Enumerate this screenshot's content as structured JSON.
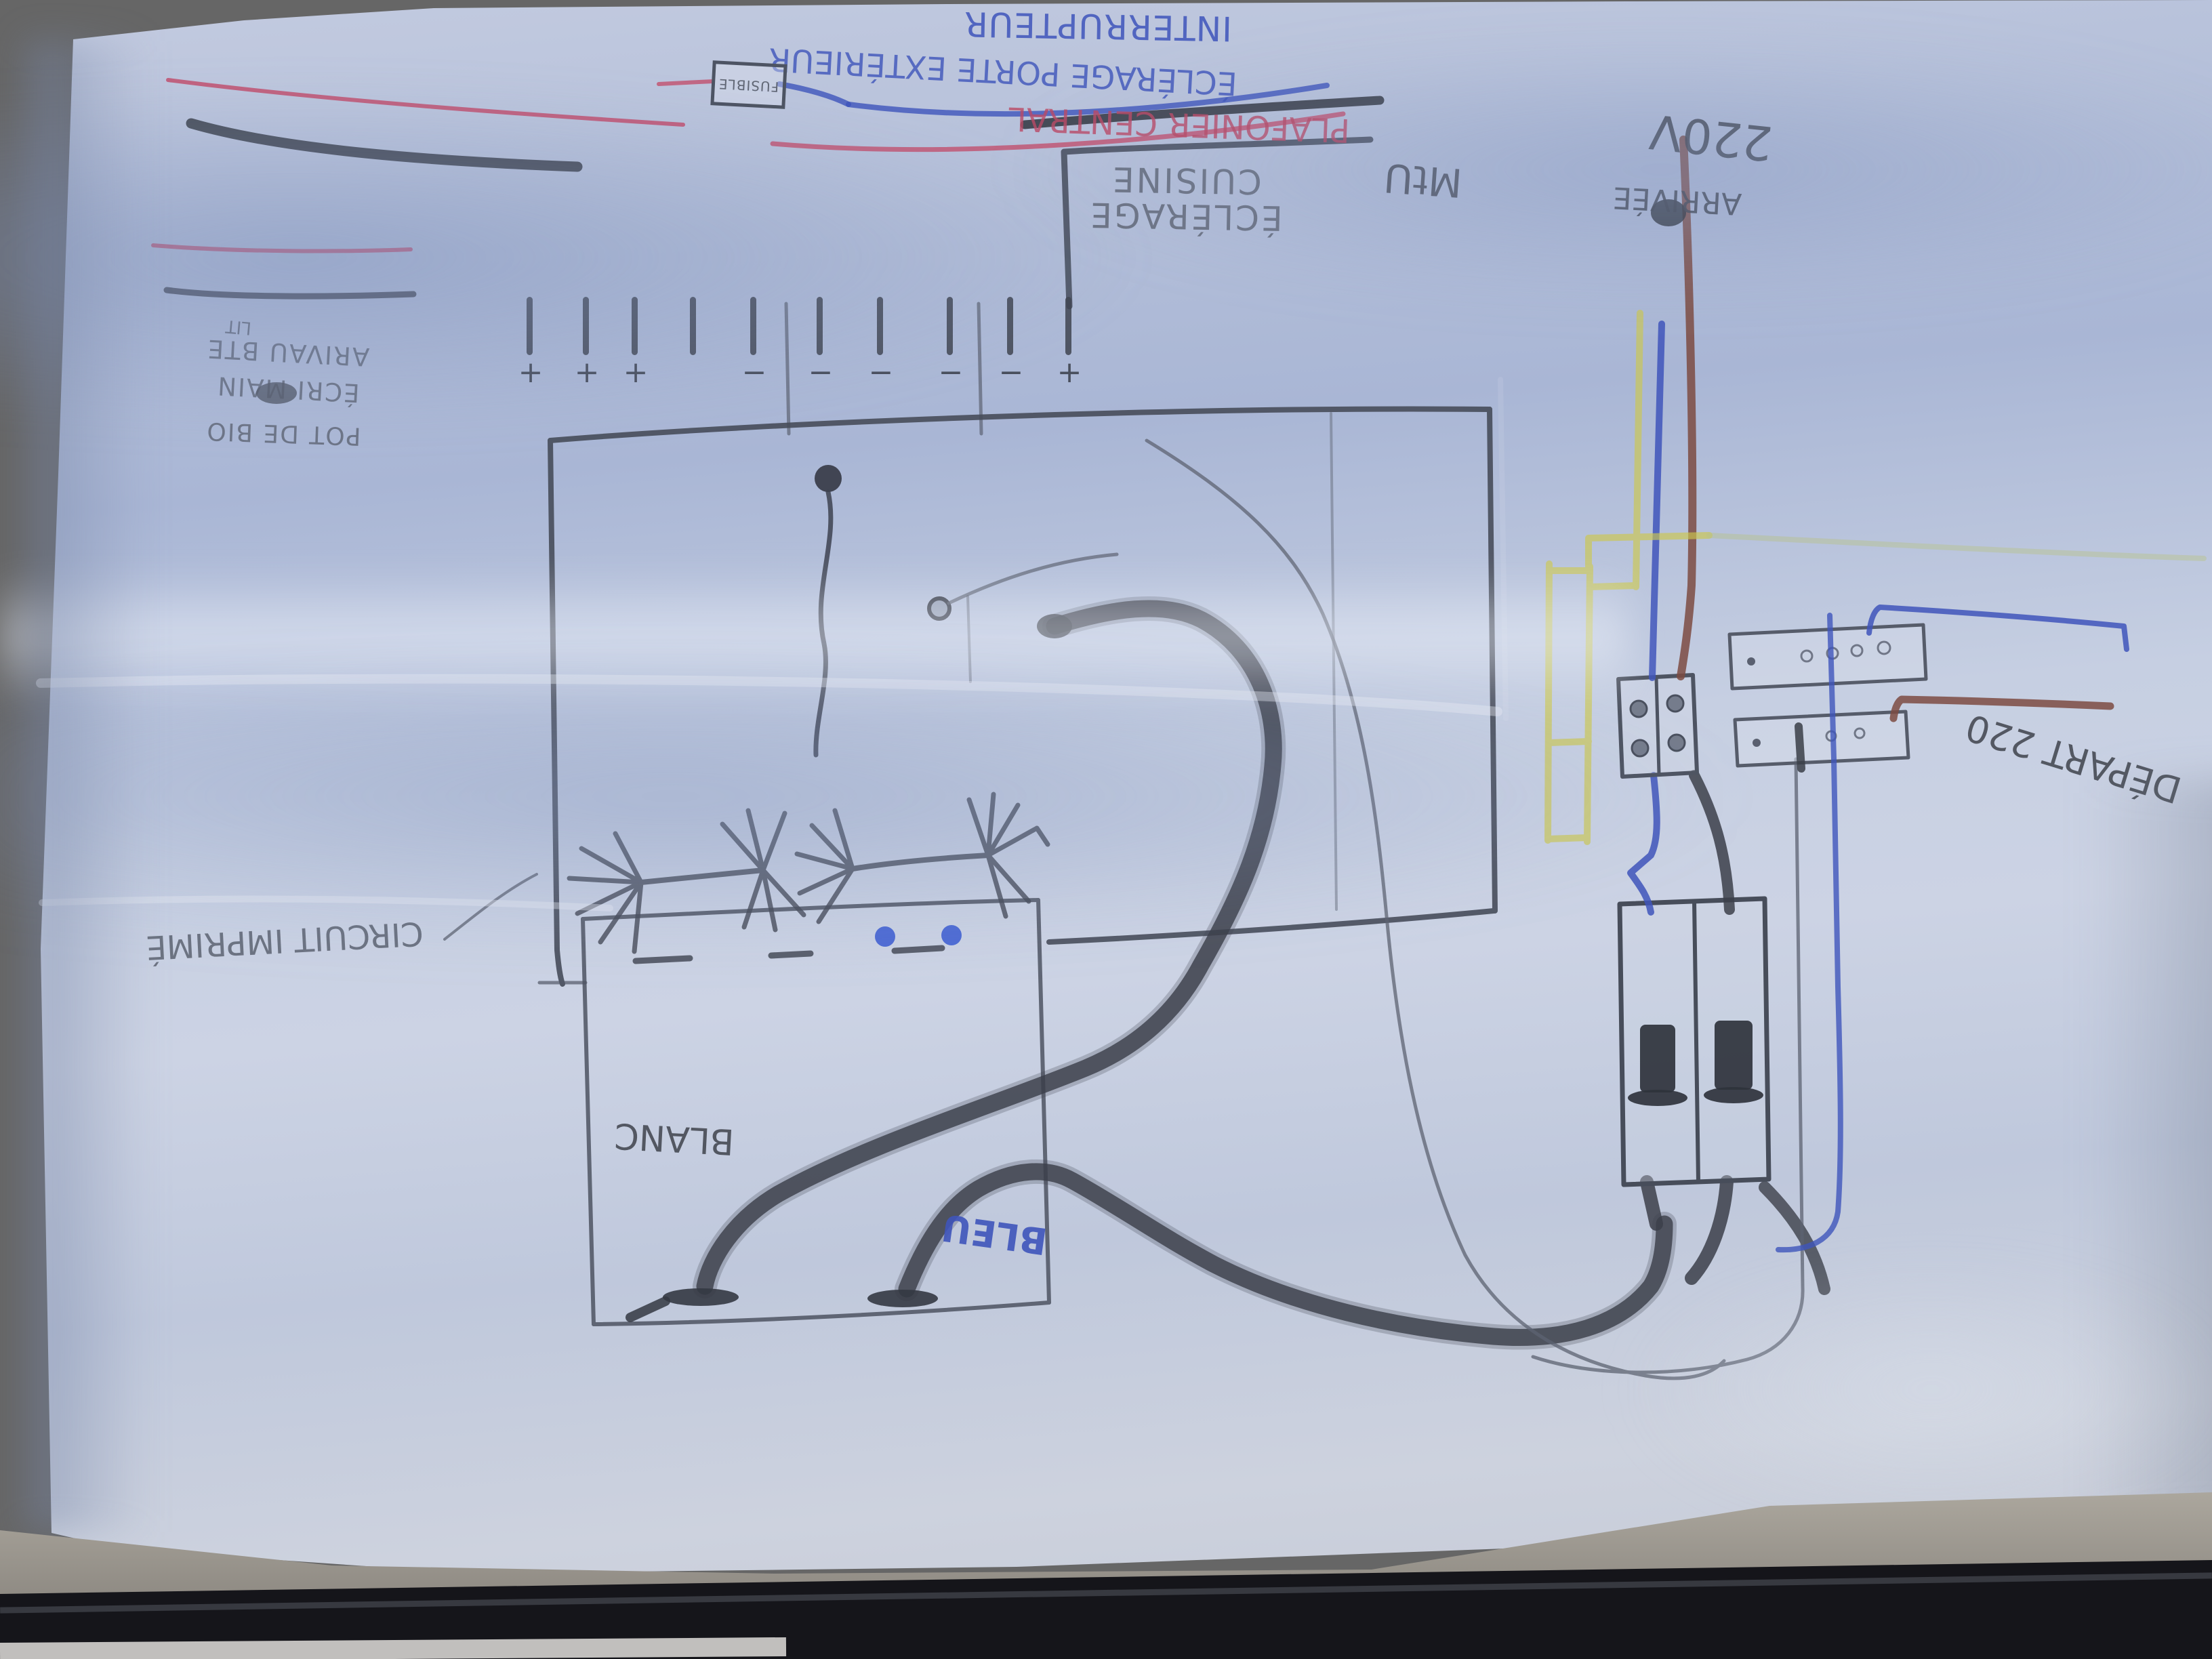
{
  "colors": {
    "paper_blue_white": "#c6cde0",
    "shadow_blue": "#8fa0c6",
    "pencil_grey": "#565c6a",
    "charcoal_wire": "#3c404a",
    "ink_blue": "#3f55bb",
    "ink_red": "#c2506e",
    "wire_yellow": "#cdc84d",
    "wire_brown": "#7c4b42",
    "dot_blue": "#4f6cd4",
    "table_grey": "#aaa59b",
    "laptop_black": "#15151a"
  },
  "labels": {
    "interrupteur": "INTERRUPTEUR",
    "eclairage_exterieur": "ÉCLÉRAGE PORTE EXTÉRIEUR",
    "plafonier_central": "PLAFONIER CENTRAL",
    "fusible": "FUSIBLE",
    "eclairage_cuisine_line1": "ÉCLÉRAGE",
    "eclairage_cuisine_line2": "CUISINE",
    "annotation_unclear": "MtU",
    "voltage": "220V",
    "arrivee": "ARRIVÉE",
    "depart": "DÉPART 220",
    "circuit_imprime": "CIRCUIT IMPRIMÉ",
    "blanc": "BLANC",
    "bleu": "BLEU",
    "note_lit": "LIT",
    "note_line1": "ARIVAU BTE",
    "note_line2": "ÉCRI MAIN",
    "note_line3": "POT DE BIO",
    "tick_signs": [
      "+",
      "+",
      "+",
      "",
      "−",
      "−",
      "−",
      "−",
      "−",
      "+"
    ]
  }
}
